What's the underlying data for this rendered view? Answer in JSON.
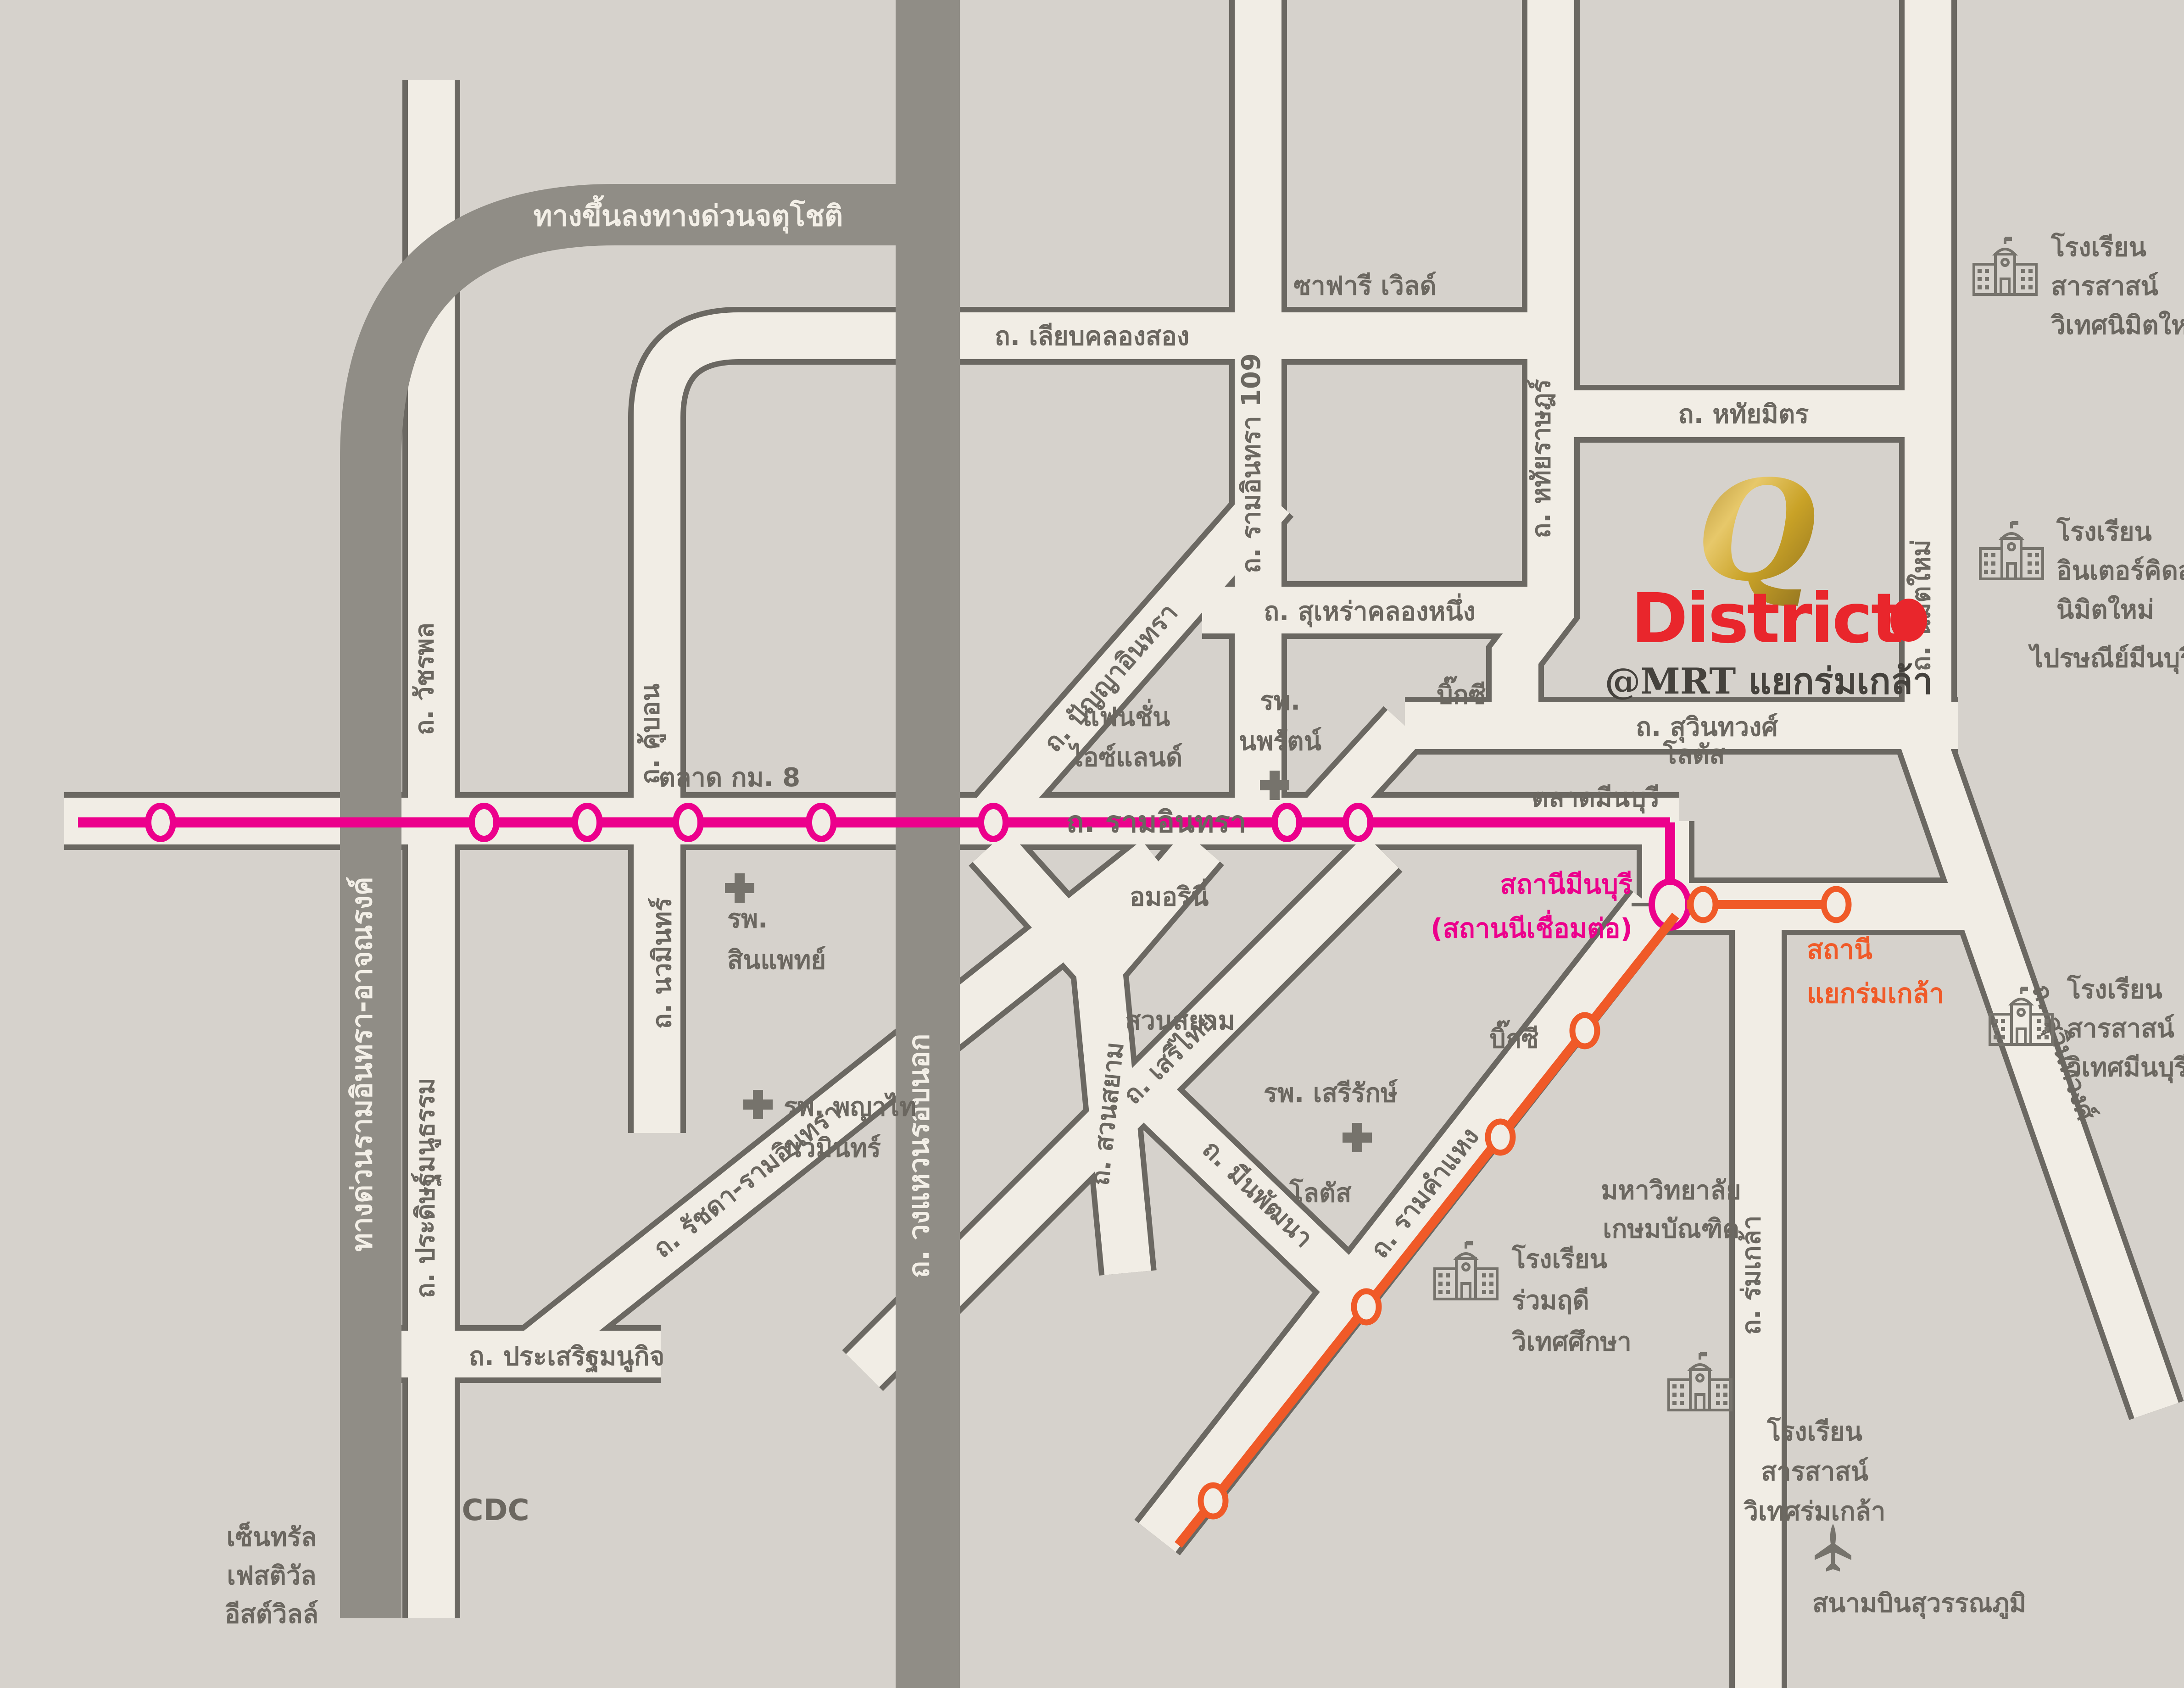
{
  "brand": {
    "q": "Q",
    "district": "District",
    "at_mrt": "@MRT แยกร่มเกล้า"
  },
  "expressways": {
    "jatuchot": "ทางขึ้นลงทางด่วนจตุโชติ",
    "ramindra_expy": "ทางด่วนรามอินทรา-อาจณรงค์",
    "outer_ring": "ถ. วงแหวนรอบนอก"
  },
  "roads": {
    "liab_khlong_song": "ถ. เลียบคลองสอง",
    "ramindra_109": "ถ. รามอินทรา 109",
    "hathai_rat": "ถ. หทัยราษฎร์",
    "hathai_mit": "ถ. หทัยมิตร",
    "nimit_mai": "ถ. นิมิตใหม่",
    "surao_khlong_nueng": "ถ. สุเหร่าคลองหนึ่ง",
    "suwinthawong": "ถ. สุวินทวงศ์",
    "ramindra": "ถ. รามอินทรา",
    "watcharaphon": "ถ. วัชรพล",
    "khubon": "ถ. คู้บอน",
    "nawamin": "ถ. นวมินทร์",
    "panya_inthra": "ถ. ปัญญาอินทรา",
    "suan_sayam": "ถ. สวนสยาม",
    "seri_thai": "ถ. เสรีไทย",
    "min_phatthana": "ถ. มีนพัฒนา",
    "ramkhamhaeng": "ถ. รามคำแหง",
    "ratchada_ramindra": "ถ. รัชดา-รามอินทรา",
    "pradit_manutham": "ถ. ประดิษฐ์มนูธรรม",
    "prasert_manukit": "ถ. ประเสริฐมนูกิจ",
    "rom_klao": "ถ. ร่มเกล้า"
  },
  "transit": {
    "minburi_line1": "สถานีมีนบุรี",
    "minburi_line2": "(สถานนีเชื่อมต่อ)",
    "yaek_rom_klao_line1": "สถานี",
    "yaek_rom_klao_line2": "แยกร่มเกล้า",
    "pink_color": "#EC008C",
    "orange_color": "#F05A28"
  },
  "places": {
    "safari_world": "ซาฟารี เวิลด์",
    "talad_km8": "ตลาด กม. 8",
    "fashion_line1": "แฟนชั่น",
    "fashion_line2": "ไอซ์แลนด์",
    "nopparat_line1": "รพ.",
    "nopparat_line2": "นพรัตน์",
    "amorini": "อมอรินี่",
    "suan_sayam_park": "สวนสยาม",
    "sinphaet_line1": "รพ.",
    "sinphaet_line2": "สินแพทย์",
    "phayathai_line1": "รพ. พญาไท",
    "phayathai_line2": "นวมินทร์",
    "serirak": "รพ. เสรีรักษ์",
    "lotus_upper": "โลตัส",
    "lotus_lower": "โลตัส",
    "bigc_upper": "บิ๊กซี",
    "bigc_lower": "บิ๊กซี",
    "talad_minburi": "ตลาดมีนบุรี",
    "cdc": "CDC",
    "central_line1": "เซ็นทรัล",
    "central_line2": "เฟสติวัล",
    "central_line3": "อีสต์วิลล์",
    "kasem_line1": "มหาวิทยาลัย",
    "kasem_line2": "เกษมบัณฑิต",
    "school_nimitmai_line1": "โรงเรียน",
    "school_nimitmai_line2": "สารสาสน์",
    "school_nimitmai_line3": "วิเทศนิมิตใหม่",
    "school_interkids_line1": "โรงเรียน",
    "school_interkids_line2": "อินเตอร์คิดส์",
    "school_interkids_line3": "นิมิตใหม่",
    "school_minburi_line1": "โรงเรียน",
    "school_minburi_line2": "สารสาสน์",
    "school_minburi_line3": "วิเทศมีนบุรี",
    "school_ruamrudee_line1": "โรงเรียน",
    "school_ruamrudee_line2": "ร่วมฤดี",
    "school_ruamrudee_line3": "วิเทศศึกษา",
    "school_romklao_line1": "โรงเรียน",
    "school_romklao_line2": "สารสาสน์",
    "school_romklao_line3": "วิเทศร่มเกล้า",
    "post_office": "ไปรษณีย์มีนบุรี",
    "airport": "สนามบินสุวรรณภูมิ"
  },
  "icons": {
    "school-icon": "building-with-flag-outline",
    "hospital-icon": "plus-cross",
    "airport-icon": "airplane-up",
    "pink-station-icon": "ellipse-ring-pink",
    "orange-station-icon": "ellipse-ring-orange",
    "interchange-station-icon": "large-ellipse-ring-pink",
    "q-district-marker-icon": "red-dot"
  },
  "colors": {
    "background": "#D6D2CC",
    "road_fill": "#F1EDE5",
    "road_casing": "#6B6862",
    "expressway": "#908D86",
    "label_text": "#6B6760",
    "pink_line": "#EC008C",
    "orange_line": "#F05A28",
    "brand_red": "#E9262C",
    "brand_gold": "#C9A227"
  }
}
